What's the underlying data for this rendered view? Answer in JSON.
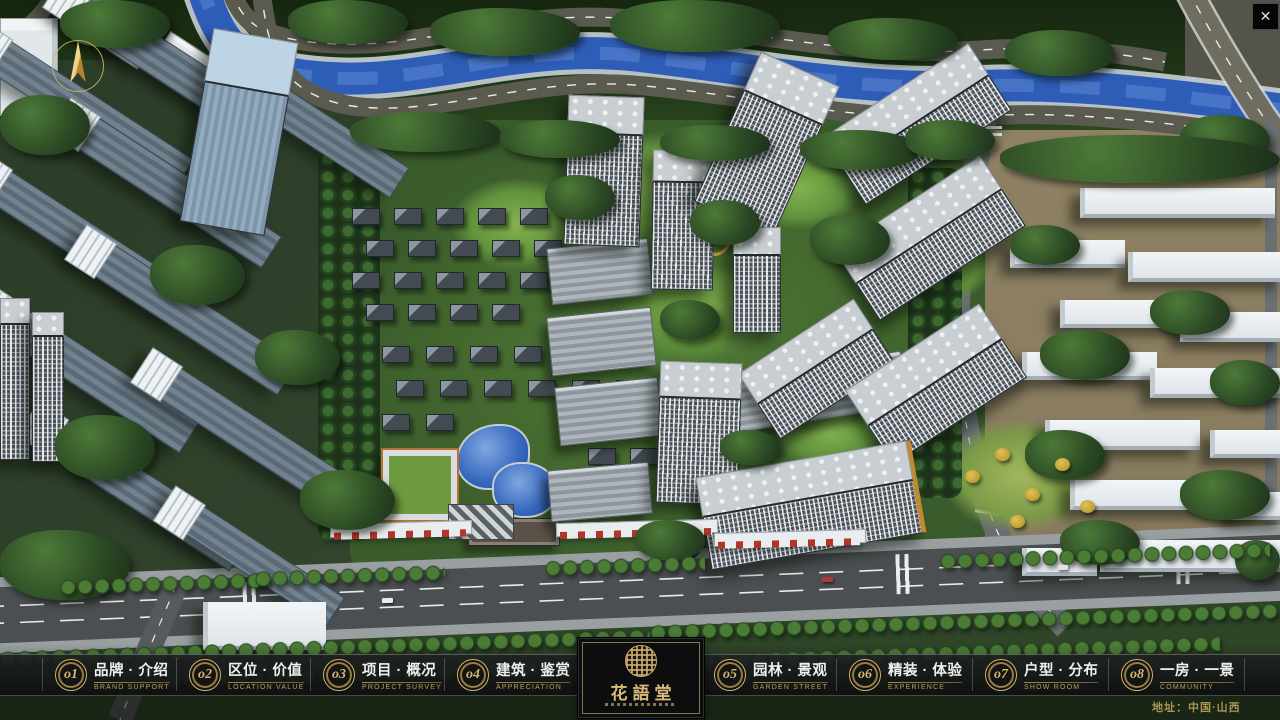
{
  "app": {
    "close_glyph": "✕",
    "address": "地址：中国·山西"
  },
  "logo": {
    "name": "花語堂"
  },
  "nav": {
    "items": [
      {
        "num": "o1",
        "label": "品牌 · 介绍",
        "sublabel": "BRAND SUPPORT"
      },
      {
        "num": "o2",
        "label": "区位 · 价值",
        "sublabel": "LOCATION VALUE"
      },
      {
        "num": "o3",
        "label": "项目 · 概况",
        "sublabel": "PROJECT SURVEY"
      },
      {
        "num": "o4",
        "label": "建筑 · 鉴赏",
        "sublabel": "APPRECIATION"
      },
      {
        "num": "o5",
        "label": "园林 · 景观",
        "sublabel": "GARDEN STREET"
      },
      {
        "num": "o6",
        "label": "精装 · 体验",
        "sublabel": "EXPERIENCE"
      },
      {
        "num": "o7",
        "label": "户型 · 分布",
        "sublabel": "SHOW ROOM"
      },
      {
        "num": "o8",
        "label": "一房 · 一景",
        "sublabel": "COMMUNITY"
      }
    ]
  },
  "colors": {
    "gold": "#c8a85c",
    "bar_bg": "rgba(16,18,20,0.82)",
    "river": "#2e5db7",
    "asphalt": "#4b4f51"
  }
}
